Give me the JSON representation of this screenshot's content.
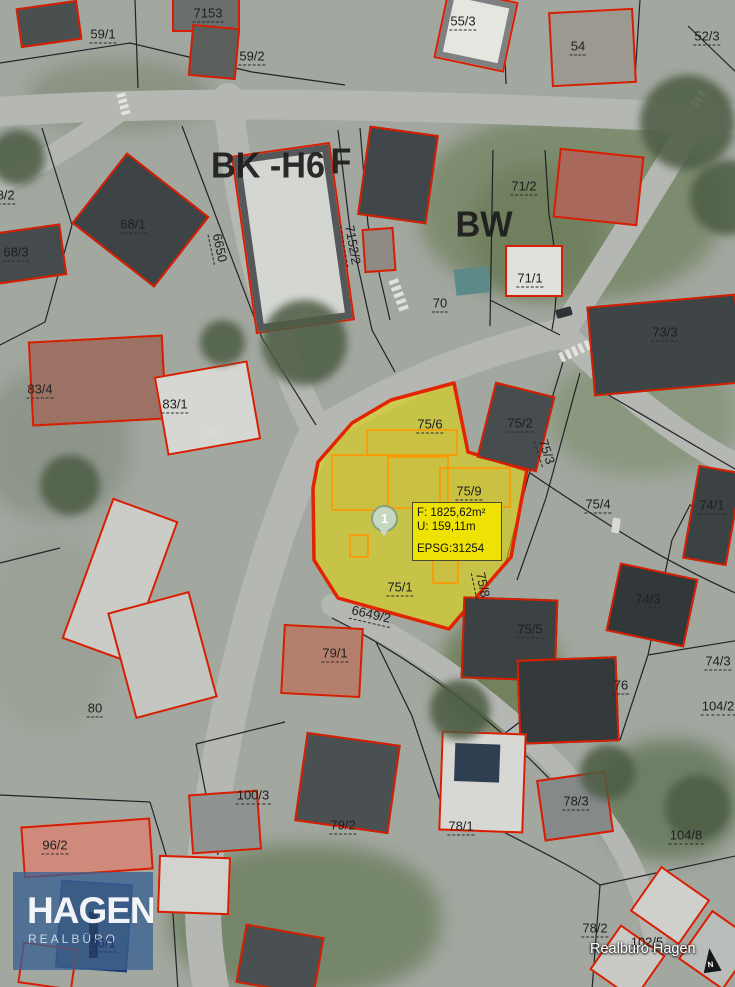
{
  "attribution": "Realbüro Hagen",
  "north_label": "N",
  "logo": {
    "title": "HAGEN",
    "subtitle": "REALBÜRO"
  },
  "highlight": {
    "marker_label": "1",
    "info_area": "F: 1825,62m²",
    "info_perimeter": "U: 159,11m",
    "info_epsg": "EPSG:31254"
  },
  "colors": {
    "highlight_fill": "#E3DA00",
    "highlight_border": "#E32400",
    "inner_outline": "#FF9800",
    "building_outline": "#D81E00",
    "info_bg": "#EEE300",
    "logo_blue": "#3A6291"
  },
  "zone_labels": [
    {
      "text": "BK -H6",
      "x": 268,
      "y": 166
    },
    {
      "text": "F",
      "x": 341,
      "y": 162
    },
    {
      "text": "BW",
      "x": 484,
      "y": 225
    }
  ],
  "parcel_labels": [
    {
      "text": "7153",
      "x": 208,
      "y": 14
    },
    {
      "text": "59/1",
      "x": 103,
      "y": 35
    },
    {
      "text": "59/2",
      "x": 252,
      "y": 57
    },
    {
      "text": "55/3",
      "x": 463,
      "y": 22
    },
    {
      "text": "54",
      "x": 578,
      "y": 47
    },
    {
      "text": "52/3",
      "x": 707,
      "y": 37
    },
    {
      "text": "68/2",
      "x": 2,
      "y": 196
    },
    {
      "text": "68/1",
      "x": 133,
      "y": 225
    },
    {
      "text": "68/3",
      "x": 16,
      "y": 253
    },
    {
      "text": "6650",
      "x": 219,
      "y": 248,
      "rot": 78
    },
    {
      "text": "83/4",
      "x": 40,
      "y": 390
    },
    {
      "text": "83/1",
      "x": 175,
      "y": 405
    },
    {
      "text": "7152/2",
      "x": 352,
      "y": 245,
      "rot": 80
    },
    {
      "text": "71/2",
      "x": 524,
      "y": 187
    },
    {
      "text": "71/1",
      "x": 530,
      "y": 279
    },
    {
      "text": "70",
      "x": 440,
      "y": 304
    },
    {
      "text": "73/3",
      "x": 665,
      "y": 333
    },
    {
      "text": "75/2",
      "x": 520,
      "y": 424
    },
    {
      "text": "75/3",
      "x": 546,
      "y": 452,
      "rot": 72
    },
    {
      "text": "75/6",
      "x": 430,
      "y": 425
    },
    {
      "text": "75/9",
      "x": 469,
      "y": 492
    },
    {
      "text": "75/4",
      "x": 598,
      "y": 505
    },
    {
      "text": "74/1",
      "x": 712,
      "y": 506
    },
    {
      "text": "75/1",
      "x": 400,
      "y": 588
    },
    {
      "text": "6649/2",
      "x": 371,
      "y": 615,
      "rot": 13
    },
    {
      "text": "75/8",
      "x": 482,
      "y": 585,
      "rot": 78
    },
    {
      "text": "75/5",
      "x": 530,
      "y": 630
    },
    {
      "text": "74/3",
      "x": 648,
      "y": 600
    },
    {
      "text": "74/3",
      "x": 718,
      "y": 662
    },
    {
      "text": "76",
      "x": 621,
      "y": 686
    },
    {
      "text": "104/2",
      "x": 718,
      "y": 707
    },
    {
      "text": "80",
      "x": 95,
      "y": 709
    },
    {
      "text": "79/1",
      "x": 335,
      "y": 654
    },
    {
      "text": "100/3",
      "x": 253,
      "y": 796
    },
    {
      "text": "79/2",
      "x": 343,
      "y": 826
    },
    {
      "text": "78/3",
      "x": 576,
      "y": 802
    },
    {
      "text": "78/1",
      "x": 461,
      "y": 827
    },
    {
      "text": "104/8",
      "x": 686,
      "y": 836
    },
    {
      "text": "96/2",
      "x": 55,
      "y": 846
    },
    {
      "text": "96/1",
      "x": 103,
      "y": 944,
      "tone": "navy"
    },
    {
      "text": "78/2",
      "x": 595,
      "y": 929
    },
    {
      "text": "102/5",
      "x": 647,
      "y": 943
    }
  ]
}
